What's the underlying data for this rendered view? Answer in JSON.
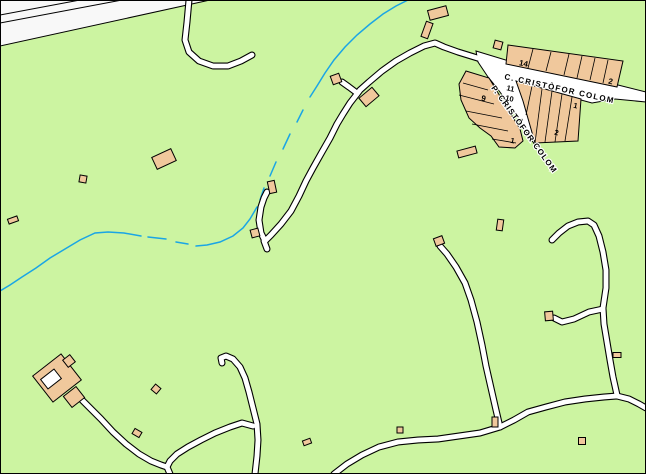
{
  "map": {
    "colors": {
      "terrain_green": "#ccf4a1",
      "building_tan": "#f0c89c",
      "outline_black": "#000000",
      "road_white": "#ffffff",
      "stream_blue": "#1aa5e5",
      "corridor_white": "#f8f8f8",
      "label_black": "#000000",
      "halo_white": "#ffffff"
    },
    "street_names": {
      "carrer": "C. CRISTÒFOR COLOM",
      "passatge": "P. CRISTÒFOR COLOM"
    },
    "house_numbers": [
      "14",
      "2",
      "11",
      "10",
      "9",
      "1",
      "1",
      "2"
    ],
    "labels": [
      {
        "t": "C. CRISTÒFOR COLOM",
        "x": 504,
        "y": 79,
        "r": 12.5,
        "s": 8,
        "sp": 1.3,
        "halo": true,
        "anchor": "start",
        "kind": "street-name"
      },
      {
        "t": "P. CRISTÒFOR COLOM",
        "x": 491,
        "y": 88,
        "r": 54,
        "s": 8,
        "sp": 1.0,
        "halo": true,
        "anchor": "start",
        "kind": "street-name"
      },
      {
        "t": "14",
        "x": 523,
        "y": 66,
        "r": 12,
        "s": 8,
        "sp": 0,
        "halo": false,
        "anchor": "middle",
        "kind": "house-number"
      },
      {
        "t": "2",
        "x": 610,
        "y": 84,
        "r": 12,
        "s": 8,
        "sp": 0,
        "halo": false,
        "anchor": "middle",
        "kind": "house-number"
      },
      {
        "t": "11",
        "x": 510,
        "y": 91,
        "r": 12,
        "s": 7.5,
        "sp": 0,
        "halo": false,
        "anchor": "middle",
        "kind": "house-number"
      },
      {
        "t": "10",
        "x": 509,
        "y": 101,
        "r": 12,
        "s": 7.5,
        "sp": 0,
        "halo": false,
        "anchor": "middle",
        "kind": "house-number"
      },
      {
        "t": "9",
        "x": 483,
        "y": 101,
        "r": 12,
        "s": 8,
        "sp": 0,
        "halo": false,
        "anchor": "middle",
        "kind": "house-number"
      },
      {
        "t": "1",
        "x": 512,
        "y": 143,
        "r": 12,
        "s": 7.5,
        "sp": 0,
        "halo": false,
        "anchor": "middle",
        "kind": "house-number"
      },
      {
        "t": "1",
        "x": 575,
        "y": 108,
        "r": 12,
        "s": 7.5,
        "sp": 0,
        "halo": false,
        "anchor": "middle",
        "kind": "house-number"
      },
      {
        "t": "2",
        "x": 556,
        "y": 135,
        "r": 12,
        "s": 7.5,
        "sp": 0,
        "halo": false,
        "anchor": "middle",
        "kind": "house-number"
      }
    ],
    "corridor": {
      "triangle": [
        [
          0,
          0
        ],
        [
          210,
          0
        ],
        [
          0,
          46
        ]
      ],
      "lines": [
        [
          [
            0,
            15
          ],
          [
            80,
            0
          ]
        ],
        [
          [
            0,
            23
          ],
          [
            122,
            0
          ]
        ]
      ]
    },
    "stream_segments": [
      [
        [
          408,
          0
        ],
        [
          396,
          6
        ],
        [
          383,
          14
        ],
        [
          370,
          24
        ],
        [
          357,
          35
        ],
        [
          345,
          47
        ],
        [
          334,
          60
        ],
        [
          325,
          73
        ],
        [
          317,
          86
        ],
        [
          310,
          97
        ]
      ],
      [
        [
          303,
          110
        ],
        [
          297,
          122
        ]
      ],
      [
        [
          290,
          134
        ],
        [
          283,
          149
        ]
      ],
      [
        [
          276,
          162
        ],
        [
          270,
          176
        ]
      ],
      [
        [
          264,
          188
        ],
        [
          260,
          200
        ]
      ],
      [
        [
          257,
          207
        ],
        [
          250,
          219
        ],
        [
          243,
          228
        ],
        [
          233,
          236
        ],
        [
          220,
          242
        ],
        [
          207,
          245
        ],
        [
          196,
          246
        ]
      ],
      [
        [
          188,
          244
        ],
        [
          176,
          242
        ]
      ],
      [
        [
          166,
          239
        ],
        [
          148,
          237
        ]
      ],
      [
        [
          141,
          236
        ],
        [
          124,
          233
        ],
        [
          108,
          232
        ],
        [
          95,
          233
        ],
        [
          80,
          240
        ],
        [
          65,
          249
        ],
        [
          50,
          258
        ],
        [
          36,
          268
        ],
        [
          22,
          277
        ],
        [
          10,
          285
        ],
        [
          0,
          291
        ]
      ]
    ],
    "street_area": [
      [
        476,
        51
      ],
      [
        509,
        61
      ],
      [
        614,
        84
      ],
      [
        646,
        92
      ],
      [
        646,
        102
      ],
      [
        615,
        99
      ],
      [
        592,
        103
      ],
      [
        581,
        100
      ],
      [
        521,
        84
      ],
      [
        528,
        98
      ],
      [
        536,
        118
      ],
      [
        541,
        138
      ],
      [
        537,
        148
      ],
      [
        529,
        136
      ],
      [
        519,
        120
      ],
      [
        508,
        103
      ],
      [
        497,
        88
      ],
      [
        488,
        77
      ],
      [
        478,
        62
      ]
    ],
    "roads": [
      [
        [
          189,
          0
        ],
        [
          187,
          22
        ],
        [
          185,
          40
        ],
        [
          189,
          52
        ],
        [
          199,
          61
        ],
        [
          213,
          66
        ],
        [
          228,
          66
        ],
        [
          241,
          61
        ],
        [
          252,
          55
        ]
      ],
      [
        [
          484,
          60
        ],
        [
          458,
          52
        ],
        [
          444,
          47
        ],
        [
          435,
          43
        ],
        [
          424,
          46
        ],
        [
          410,
          53
        ],
        [
          396,
          61
        ],
        [
          382,
          71
        ],
        [
          369,
          82
        ],
        [
          360,
          90
        ],
        [
          357,
          94
        ]
      ],
      [
        [
          357,
          94
        ],
        [
          350,
          103
        ],
        [
          343,
          114
        ],
        [
          337,
          124
        ],
        [
          330,
          138
        ],
        [
          322,
          152
        ],
        [
          313,
          168
        ],
        [
          306,
          181
        ],
        [
          299,
          196
        ],
        [
          291,
          211
        ],
        [
          281,
          224
        ],
        [
          271,
          235
        ],
        [
          265,
          241
        ],
        [
          261,
          233
        ],
        [
          259,
          220
        ],
        [
          261,
          207
        ],
        [
          264,
          198
        ],
        [
          267,
          192
        ]
      ],
      [
        [
          264,
          241
        ],
        [
          267,
          249
        ]
      ],
      [
        [
          357,
          93
        ],
        [
          349,
          87
        ],
        [
          342,
          82
        ]
      ],
      [
        [
          440,
          246
        ],
        [
          447,
          254
        ],
        [
          456,
          267
        ],
        [
          465,
          283
        ],
        [
          471,
          300
        ],
        [
          477,
          322
        ],
        [
          482,
          345
        ],
        [
          486,
          366
        ],
        [
          491,
          388
        ],
        [
          496,
          410
        ],
        [
          500,
          427
        ]
      ],
      [
        [
          552,
          240
        ],
        [
          559,
          233
        ],
        [
          568,
          226
        ],
        [
          578,
          222
        ],
        [
          588,
          221
        ],
        [
          594,
          225
        ],
        [
          599,
          236
        ],
        [
          603,
          252
        ],
        [
          606,
          270
        ],
        [
          606,
          288
        ],
        [
          603,
          308
        ],
        [
          604,
          324
        ],
        [
          607,
          342
        ],
        [
          610,
          360
        ],
        [
          613,
          377
        ],
        [
          617,
          395
        ]
      ],
      [
        [
          603,
          309
        ],
        [
          589,
          312
        ],
        [
          574,
          319
        ],
        [
          562,
          322
        ],
        [
          554,
          318
        ]
      ],
      [
        [
          334,
          474
        ],
        [
          347,
          464
        ],
        [
          362,
          455
        ],
        [
          379,
          447
        ],
        [
          398,
          442
        ],
        [
          418,
          440
        ],
        [
          438,
          439
        ],
        [
          459,
          436
        ],
        [
          480,
          433
        ],
        [
          500,
          427
        ],
        [
          514,
          420
        ],
        [
          528,
          412
        ],
        [
          546,
          407
        ],
        [
          565,
          402
        ],
        [
          585,
          399
        ],
        [
          604,
          397
        ],
        [
          617,
          396
        ],
        [
          629,
          399
        ],
        [
          639,
          404
        ],
        [
          646,
          408
        ]
      ],
      [
        [
          255,
          474
        ],
        [
          257,
          456
        ],
        [
          258,
          440
        ],
        [
          257,
          424
        ],
        [
          253,
          408
        ],
        [
          249,
          392
        ],
        [
          245,
          378
        ],
        [
          240,
          367
        ],
        [
          233,
          359
        ],
        [
          226,
          356
        ],
        [
          221,
          358
        ],
        [
          222,
          363
        ]
      ],
      [
        [
          253,
          426
        ],
        [
          242,
          423
        ],
        [
          230,
          427
        ],
        [
          215,
          433
        ],
        [
          201,
          440
        ],
        [
          188,
          447
        ],
        [
          177,
          454
        ],
        [
          170,
          461
        ],
        [
          167,
          467
        ],
        [
          170,
          474
        ]
      ],
      [
        [
          79,
          397
        ],
        [
          90,
          408
        ],
        [
          101,
          419
        ],
        [
          113,
          432
        ],
        [
          126,
          444
        ],
        [
          139,
          454
        ],
        [
          151,
          461
        ],
        [
          161,
          465
        ],
        [
          167,
          467
        ]
      ]
    ],
    "building_rows": [
      {
        "outline": [
          [
            508,
            45
          ],
          [
            623,
            61
          ],
          [
            617,
            87
          ],
          [
            506,
            64
          ]
        ],
        "dividers": [
          [
            [
              533,
              49
            ],
            [
              528,
              68
            ]
          ],
          [
            [
              551,
              52
            ],
            [
              546,
              71
            ]
          ],
          [
            [
              569,
              54
            ],
            [
              564,
              75
            ]
          ],
          [
            [
              582,
              56
            ],
            [
              577,
              78
            ]
          ],
          [
            [
              595,
              58
            ],
            [
              590,
              80
            ]
          ],
          [
            [
              608,
              60
            ],
            [
              603,
              83
            ]
          ]
        ]
      },
      {
        "outline": [
          [
            516,
            81
          ],
          [
            581,
            99
          ],
          [
            578,
            141
          ],
          [
            535,
            143
          ],
          [
            523,
            101
          ]
        ],
        "dividers": [
          [
            [
              532,
              86
            ],
            [
              526,
              115
            ]
          ],
          [
            [
              542,
              89
            ],
            [
              535,
              143
            ]
          ],
          [
            [
              552,
              91
            ],
            [
              545,
              142
            ]
          ],
          [
            [
              562,
              94
            ],
            [
              555,
              142
            ]
          ],
          [
            [
              572,
              97
            ],
            [
              565,
              141
            ]
          ]
        ]
      },
      {
        "outline": [
          [
            466,
            71
          ],
          [
            489,
            78
          ],
          [
            520,
            129
          ],
          [
            523,
            141
          ],
          [
            515,
            148
          ],
          [
            499,
            147
          ],
          [
            491,
            136
          ],
          [
            480,
            128
          ],
          [
            469,
            118
          ],
          [
            461,
            100
          ],
          [
            459,
            84
          ]
        ],
        "dividers": [
          [
            [
              463,
              83
            ],
            [
              488,
              90
            ]
          ],
          [
            [
              459,
              95
            ],
            [
              494,
              104
            ]
          ],
          [
            [
              466,
              111
            ],
            [
              502,
              118
            ]
          ],
          [
            [
              472,
              124
            ],
            [
              508,
              131
            ]
          ],
          [
            [
              492,
              139
            ],
            [
              516,
              143
            ]
          ]
        ]
      }
    ],
    "buildings": [
      {
        "cx": 438,
        "cy": 13,
        "w": 19,
        "h": 10,
        "r": -15
      },
      {
        "cx": 427,
        "cy": 30,
        "w": 7,
        "h": 16,
        "r": 20
      },
      {
        "cx": 336,
        "cy": 79,
        "w": 9,
        "h": 9,
        "r": -20
      },
      {
        "cx": 369,
        "cy": 97,
        "w": 17,
        "h": 11,
        "r": -40
      },
      {
        "cx": 164,
        "cy": 159,
        "w": 21,
        "h": 13,
        "r": -25
      },
      {
        "cx": 83,
        "cy": 179,
        "w": 7,
        "h": 7,
        "r": 10
      },
      {
        "cx": 13,
        "cy": 220,
        "w": 10,
        "h": 5,
        "r": -20
      },
      {
        "cx": 272,
        "cy": 187,
        "w": 7,
        "h": 12,
        "r": -12
      },
      {
        "cx": 255,
        "cy": 233,
        "w": 8,
        "h": 8,
        "r": -15
      },
      {
        "cx": 498,
        "cy": 45,
        "w": 8,
        "h": 8,
        "r": 15
      },
      {
        "cx": 467,
        "cy": 152,
        "w": 19,
        "h": 7,
        "r": -15
      },
      {
        "cx": 439,
        "cy": 241,
        "w": 9,
        "h": 8,
        "r": -20
      },
      {
        "cx": 500,
        "cy": 225,
        "w": 6,
        "h": 11,
        "r": 8
      },
      {
        "cx": 549,
        "cy": 316,
        "w": 8,
        "h": 9,
        "r": -5
      },
      {
        "cx": 617,
        "cy": 355,
        "w": 8,
        "h": 5,
        "r": 0
      },
      {
        "cx": 582,
        "cy": 441,
        "w": 7,
        "h": 7,
        "r": 0
      },
      {
        "cx": 495,
        "cy": 422,
        "w": 6,
        "h": 10,
        "r": 0
      },
      {
        "cx": 307,
        "cy": 442,
        "w": 8,
        "h": 5,
        "r": -20
      },
      {
        "cx": 400,
        "cy": 430,
        "w": 6,
        "h": 6,
        "r": 0
      },
      {
        "cx": 156,
        "cy": 389,
        "w": 7,
        "h": 7,
        "r": 40
      },
      {
        "cx": 137,
        "cy": 433,
        "w": 8,
        "h": 6,
        "r": 30
      },
      {
        "cx": 57,
        "cy": 378,
        "w": 36,
        "h": 33,
        "r": -38
      },
      {
        "cx": 69,
        "cy": 361,
        "w": 9,
        "h": 9,
        "r": -38
      },
      {
        "cx": 74,
        "cy": 397,
        "w": 16,
        "h": 14,
        "r": -38
      }
    ],
    "courtyards": [
      {
        "cx": 51,
        "cy": 379,
        "w": 17,
        "h": 12,
        "r": -38
      }
    ],
    "style": {
      "road_casing_width": 7,
      "road_fill_width": 4.8,
      "stream_width": 1.5
    }
  }
}
